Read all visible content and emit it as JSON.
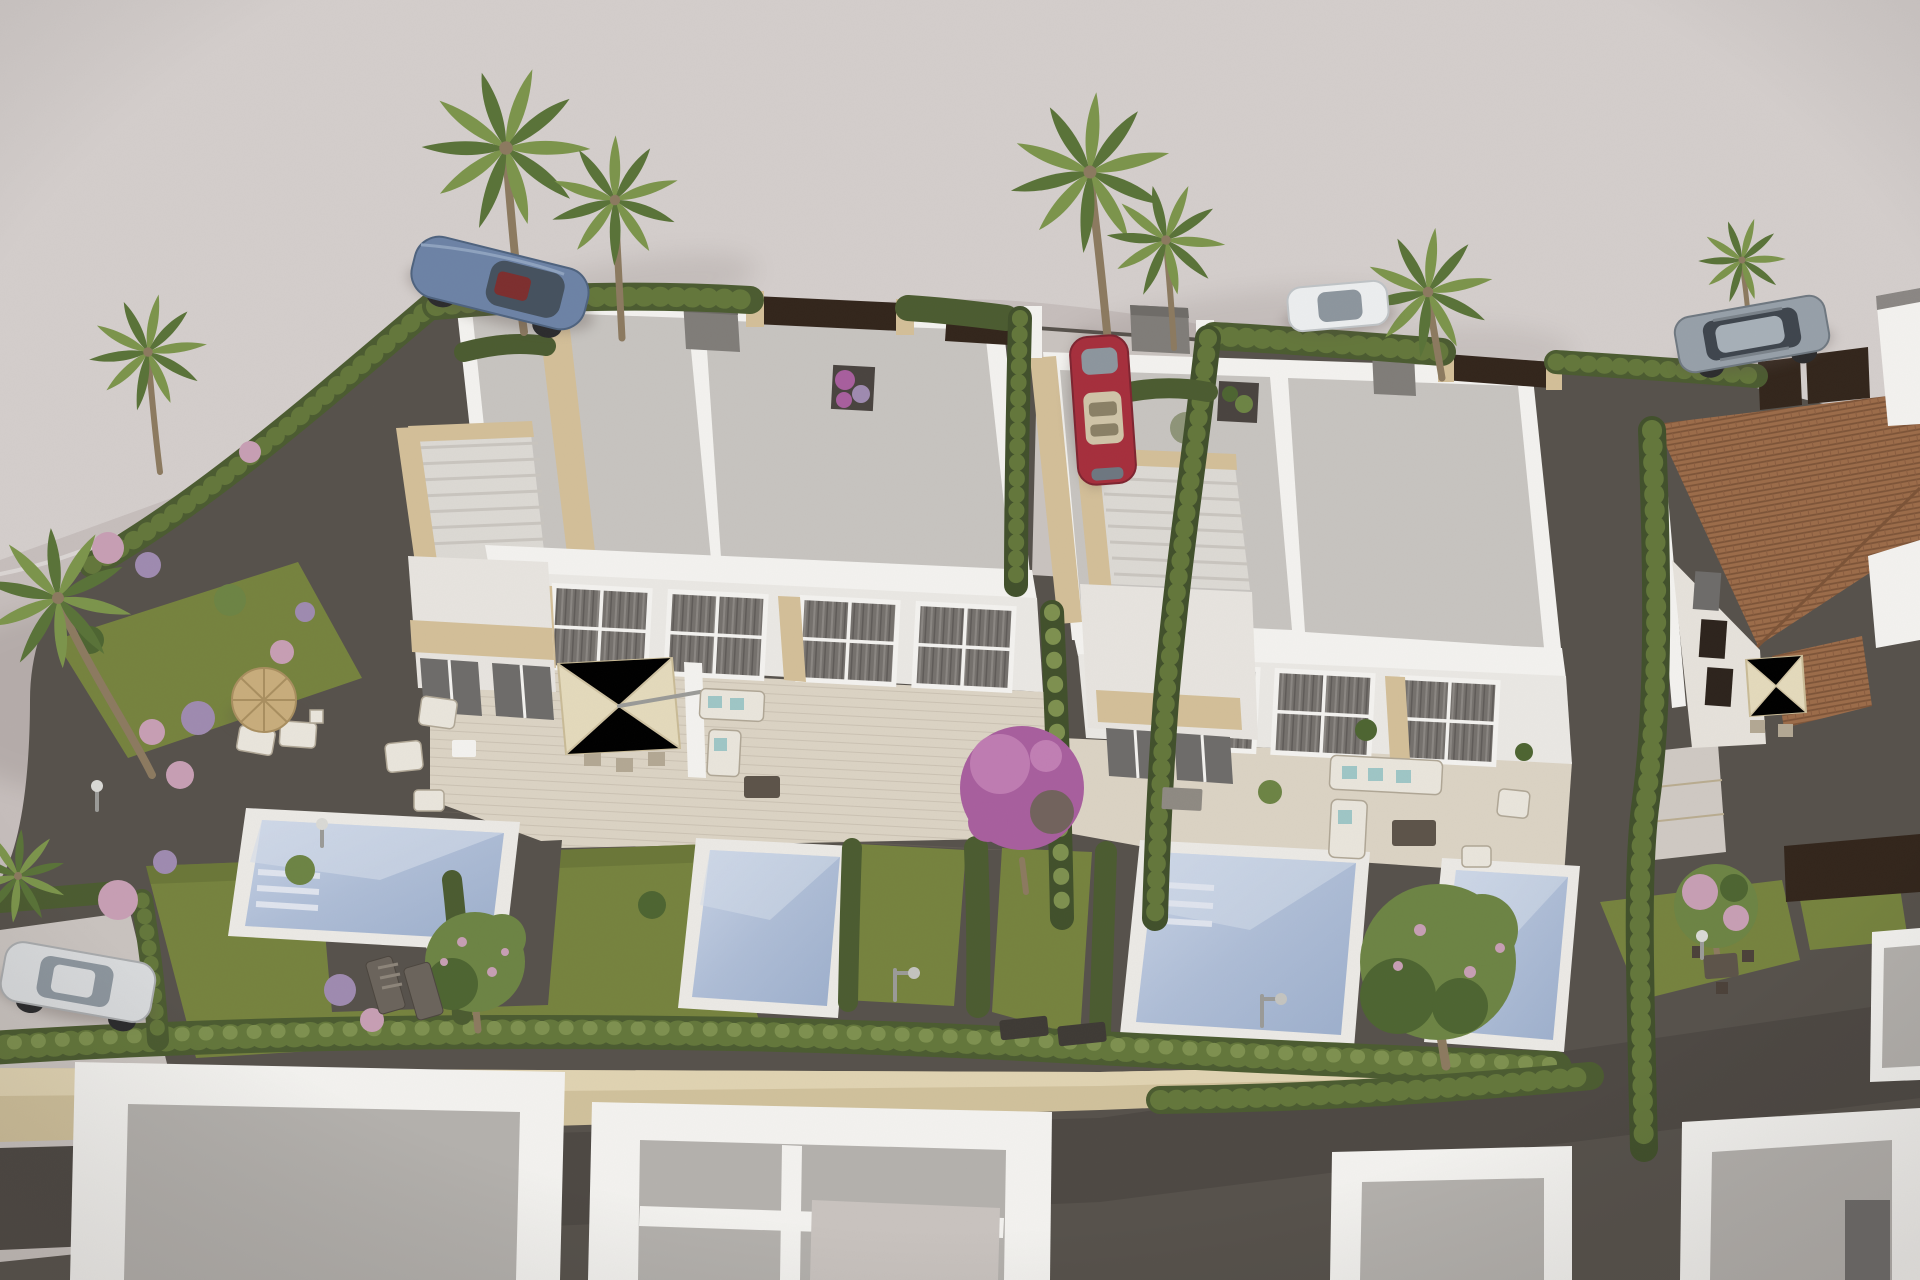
{
  "meta": {
    "title": "Aerial 3D visualisation - new-build villa development with private pools",
    "type": "architectural-render",
    "view": "bird's-eye oblique"
  },
  "palette": {
    "road": "#c6bebc",
    "roadLight": "#d8d3d1",
    "shadowC": "#5a4e49",
    "gravel": "#57524c",
    "gravelLight": "#6e6862",
    "pad": "#c9c3bf",
    "lawn": "#76833f",
    "lawnDark": "#5f6c33",
    "hedge": "#4c5c31",
    "hedgeMid": "#64773c",
    "hedgeLight": "#7e9150",
    "cypress": "#42512c",
    "white": "#f3f2ef",
    "whiteShade": "#dcd9d4",
    "roof": "#c7c4c0",
    "roofShade": "#b4b1ad",
    "stone": "#d3bf99",
    "stoneDark": "#b9a277",
    "deck": "#dbd3c4",
    "poolRim": "#ebe9e5",
    "water": "#a8b7d2",
    "waterLight": "#ccd6e8",
    "wall": "#d0c19c",
    "wallLight": "#e0d3b2",
    "pathDark": "#4e4944",
    "terracotta": "#9c6c4a",
    "terracottaDark": "#7c5438",
    "fence": "#33261c",
    "darkGlass": "#6e6c6a",
    "chimney": "#807d79",
    "carBlue": "#6d83a6",
    "carRed": "#a62f3d",
    "carSilver": "#d8dadc",
    "carGray": "#97a0a9",
    "carWhite": "#eceeef",
    "glass": "#46525f",
    "glassLight": "#8d969e",
    "parasol": "#e4dabc",
    "parasolEdge": "#c9bb97",
    "straw": "#c8ad7c",
    "strawEdge": "#a98f60",
    "furnLight": "#e9e5dc",
    "furnFrame": "#b0a796",
    "teal": "#9fc6c6",
    "tableDark": "#5d544a",
    "mat": "#3f3b36",
    "trunk": "#8c7a60",
    "palmA": "#7c954c",
    "palmB": "#5a7339",
    "bloomPink": "#c79fb4",
    "bloomLilac": "#9f8bb0",
    "bougain": "#a85f9e",
    "bougainLight": "#c17fb4",
    "treeGreen": "#6d8445",
    "treeDark": "#4e6532",
    "stairLine": "#c9c5bf",
    "stepStone": "#cfc9c3",
    "metal": "#9b9b98"
  },
  "scene": {
    "setting": "Two modern white semi-detached villas with flat gravel roofs, roof terraces, travertine accents, private gardens and four swimming pools, bordered by cypress hedges; curved empty road above, neighbouring flat roofs below, terracotta-roof house at right.",
    "objects": [
      {
        "name": "road",
        "label": "Curved light-grey access road and pavement"
      },
      {
        "name": "villa-left",
        "label": "Left semi-detached villa with flat roof, roof terrace and glazed facade"
      },
      {
        "name": "villa-right",
        "label": "Right semi-detached villa with flat roof, roof terrace and glazed facade"
      },
      {
        "name": "pools",
        "label": "Four rectangular private swimming pools with white copings"
      },
      {
        "name": "gardens",
        "label": "Gravel gardens with lawns, flowering shrubs and stepping stones"
      },
      {
        "name": "hedges",
        "label": "Clipped cypress hedge rows dividing the plots"
      },
      {
        "name": "palms",
        "label": "Tall fan palms around the plots"
      },
      {
        "name": "car-blue",
        "label": "Blue sports coupe parked on the road, top left"
      },
      {
        "name": "car-red",
        "label": "Red hatchback parked in the central driveway"
      },
      {
        "name": "car-silver",
        "label": "Silver hatchback parked at the lower-left parking pad"
      },
      {
        "name": "car-white",
        "label": "White car on the road behind the central palms"
      },
      {
        "name": "car-suv",
        "label": "Grey SUV parked on the road, top right"
      },
      {
        "name": "house-terracotta",
        "label": "Neighbouring house with terracotta tiled roof, right side"
      },
      {
        "name": "neighbour-roofs",
        "label": "White parapet flat roofs of neighbouring homes along the bottom"
      },
      {
        "name": "stone-wall",
        "label": "Long beige stone boundary wall with gravel path"
      },
      {
        "name": "furniture",
        "label": "Outdoor furniture: parasols, dining sets, sofas and sun loungers"
      }
    ]
  }
}
